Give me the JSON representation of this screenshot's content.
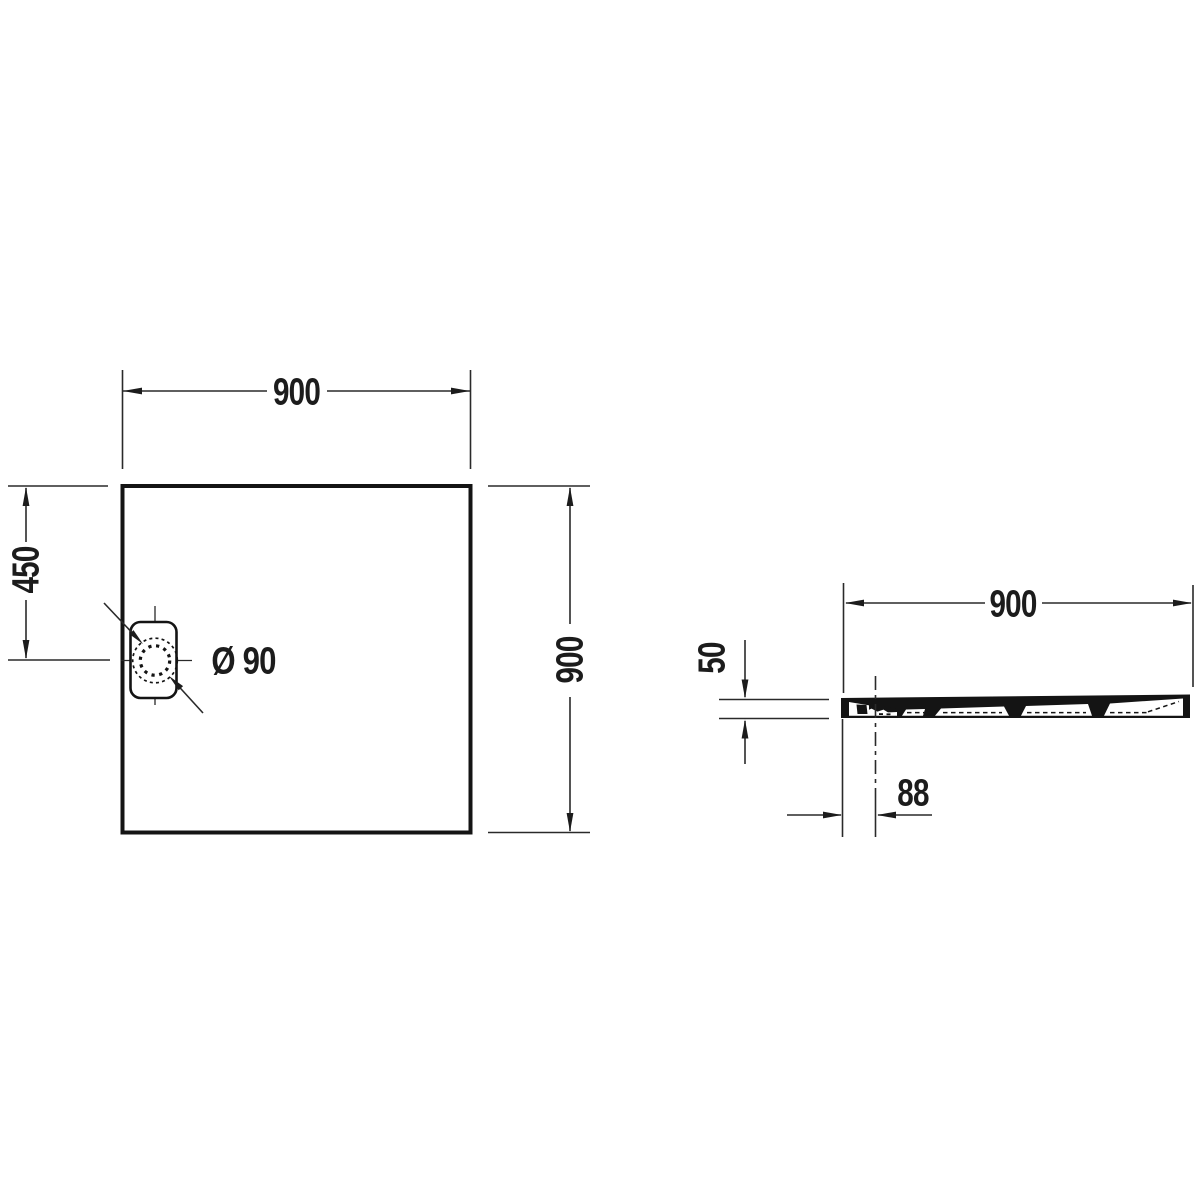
{
  "colors": {
    "line": "#1c1c1c",
    "background": "#ffffff"
  },
  "top_view": {
    "width_label": "900",
    "height_label": "900",
    "drain_offset_label": "450",
    "drain_diameter_label": "Ø 90"
  },
  "side_view": {
    "width_label": "900",
    "height_label": "50",
    "drain_offset_label": "88"
  }
}
